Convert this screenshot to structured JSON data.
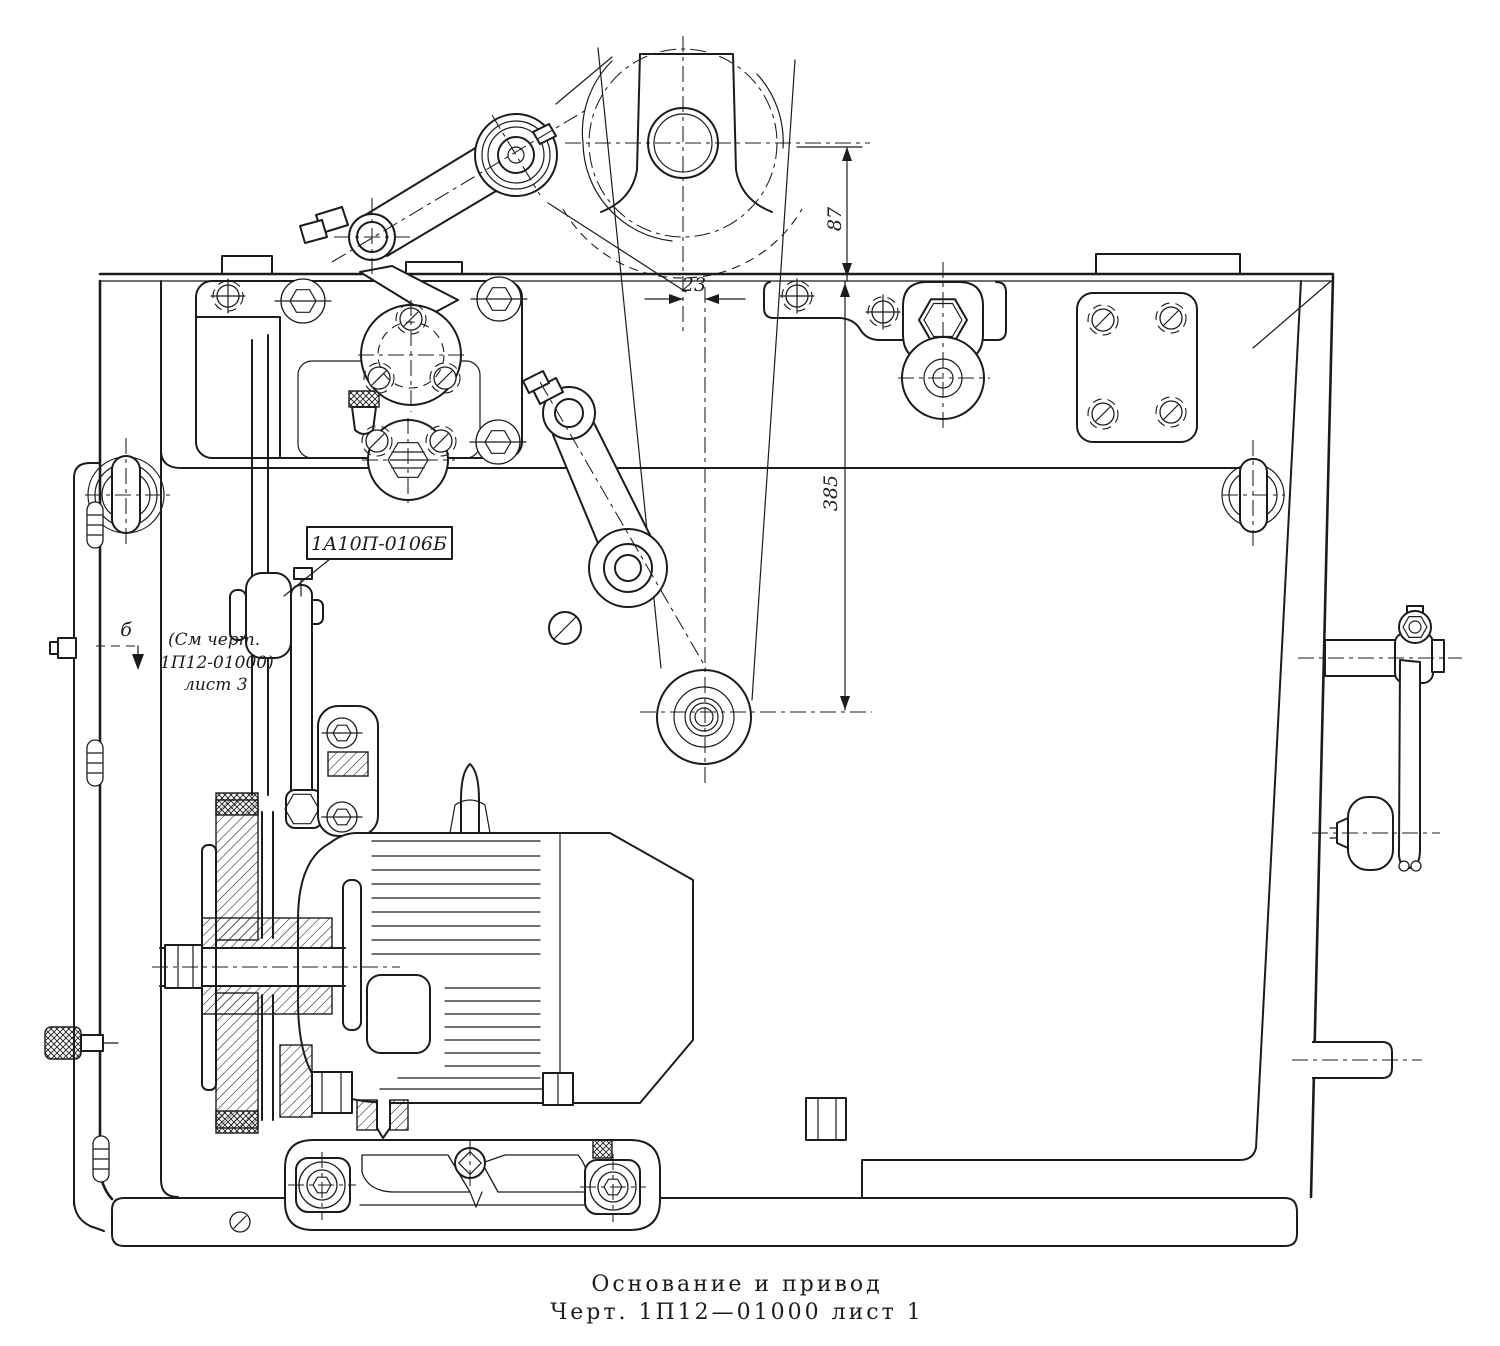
{
  "drawing": {
    "caption": {
      "line1": "Основание и привод",
      "line2": "Черт. 1П12—01000 лист 1"
    },
    "labels": {
      "part_ref": "1А10П-0106Б",
      "note_line1": "(См черт.",
      "note_line2": "1П12-01000)",
      "note_line3": "лист 3",
      "view_arrow": "б"
    },
    "dimensions": {
      "pulley_offset": "23",
      "center_height": "87",
      "idler_drop": "385"
    },
    "colors": {
      "ink": "#1c1c1c",
      "paper": "#ffffff"
    }
  }
}
